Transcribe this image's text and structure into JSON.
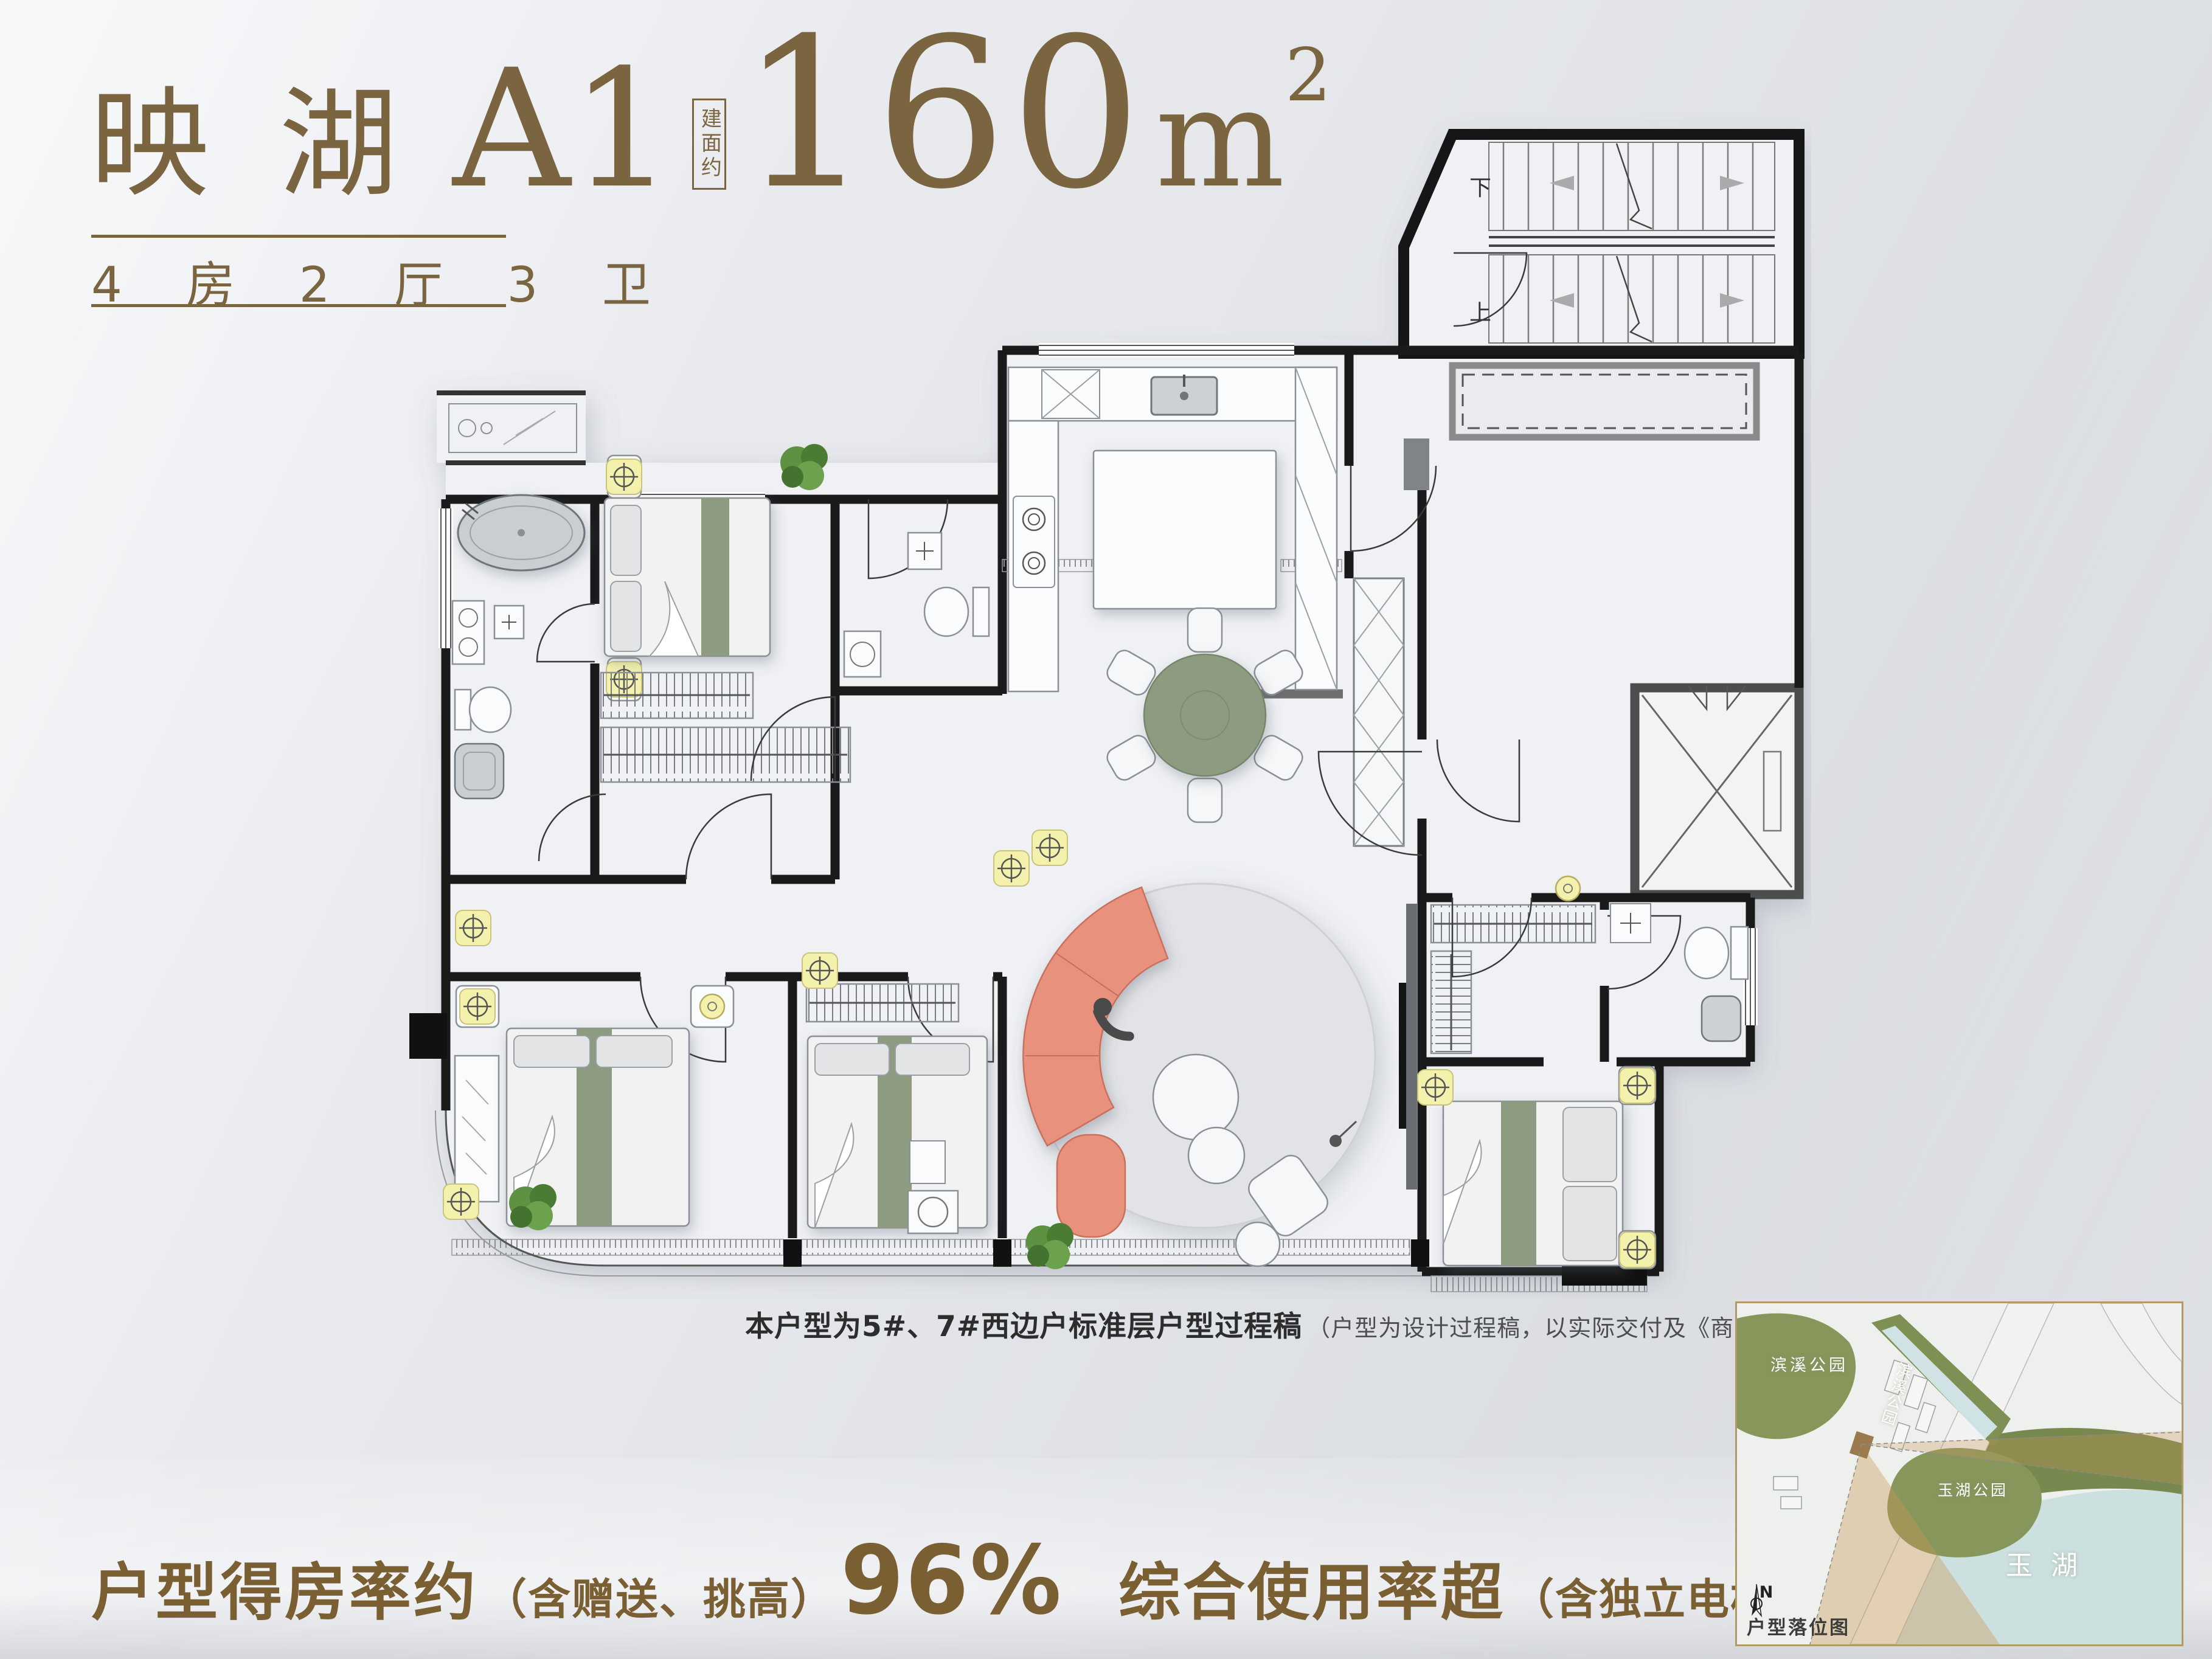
{
  "header": {
    "project": "映 湖",
    "unit": "A1",
    "area_prefix": "建面约",
    "area_value": "160",
    "area_unit": "m",
    "area_sup": "2",
    "layout": "4 房 2 厅 3 卫"
  },
  "plan": {
    "stair_down": "下",
    "stair_up": "上"
  },
  "caption": {
    "main": "本户型为5#、7#西边户标准层户型过程稿",
    "note": "（户型为设计过程稿，以实际交付及《商品房买卖合同》为准）"
  },
  "stats": {
    "ratio_label": "户型得房率约",
    "ratio_note": "（含赠送、挑高）",
    "ratio_value": "96%",
    "usage_label": "综合使用率超",
    "usage_note": "（含独立电梯厅）",
    "usage_value": "100%"
  },
  "map": {
    "park_left": "滨溪公园",
    "park_strip": "滨溪公园",
    "park_center": "玉湖公园",
    "lake": "玉湖",
    "compass": "N",
    "title": "户型落位图"
  },
  "colors": {
    "title_bronze": "#7b6540",
    "stats_bronze": "#7a5f33",
    "wall_black": "#1a1a1a",
    "sofa_coral": "#e8917b",
    "bed_sage": "#8d9c80",
    "dining_green": "#8d9c80",
    "rug_gray": "#e2e3e6",
    "lamp_yellow": "#f4f1ad",
    "plant_green": "#5f9143",
    "map_water": "#cde0e0",
    "map_park": "#87975c",
    "map_cone": "#ca9652",
    "map_border": "#b29a66"
  }
}
